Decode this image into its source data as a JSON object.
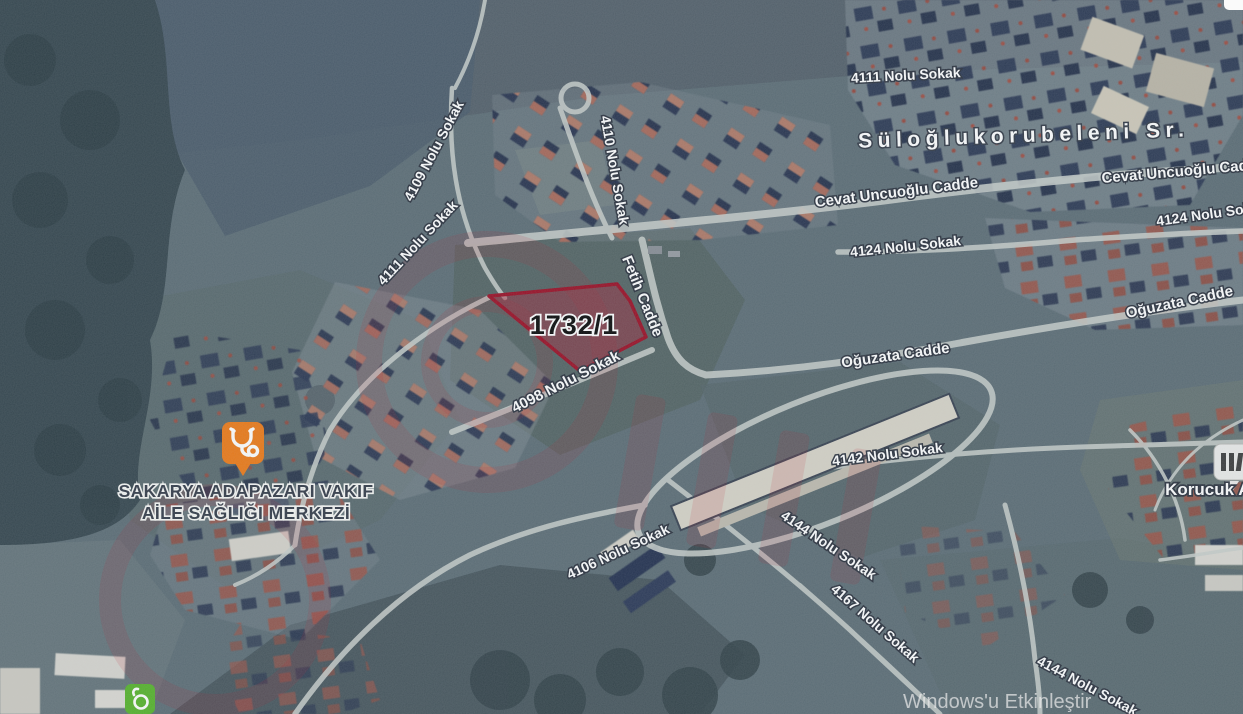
{
  "labels": {
    "s4111_top": "4111 Nolu Sokak",
    "mahalle": "Süloğlukorubeleni Sr.",
    "cevat_mid": "Cevat Uncuoğlu Cadde",
    "cevat_right": "Cevat Uncuoğlu Cadde",
    "s4124_right": "4124 Nolu Sokak",
    "s4124_mid": "4124 Nolu Sokak",
    "oguzata_right": "Oğuzata Cadde",
    "oguzata_mid": "Oğuzata Cadde",
    "s4109": "4109 Nolu Sokak",
    "s4111_left": "4111 Nolu Sokak",
    "s4110": "4110 Nolu Sokak",
    "fetih": "Fetih Cadde",
    "s4098": "4098 Nolu Sokak",
    "s4142": "4142 Nolu Sokak",
    "s4106": "4106 Nolu Sokak",
    "s4144": "4144 Nolu Sokak",
    "s4167": "4167 Nolu Sokak",
    "s4144_br": "4144 Nolu Sokak"
  },
  "parcel": {
    "number": "1732/1"
  },
  "poi": {
    "health_center_line1": "SAKARYA ADAPAZARI VAKIF",
    "health_center_line2": "AİLE SAĞLIĞI MERKEZİ",
    "korucuk": "Korucuk An"
  },
  "system": {
    "activate_windows": "Windows'u Etkinleştir"
  },
  "colors": {
    "parcel_fill": "#b02038",
    "parcel_border": "#9c1026",
    "health_marker": "#ee7b18",
    "green_marker": "#58b42c",
    "school_marker_bg": "#ececea",
    "road": "#c9cecb"
  },
  "icons": {
    "health_marker": "stethoscope-icon",
    "green_marker": "mosque-icon",
    "right_edge_marker": "school-building-icon"
  }
}
